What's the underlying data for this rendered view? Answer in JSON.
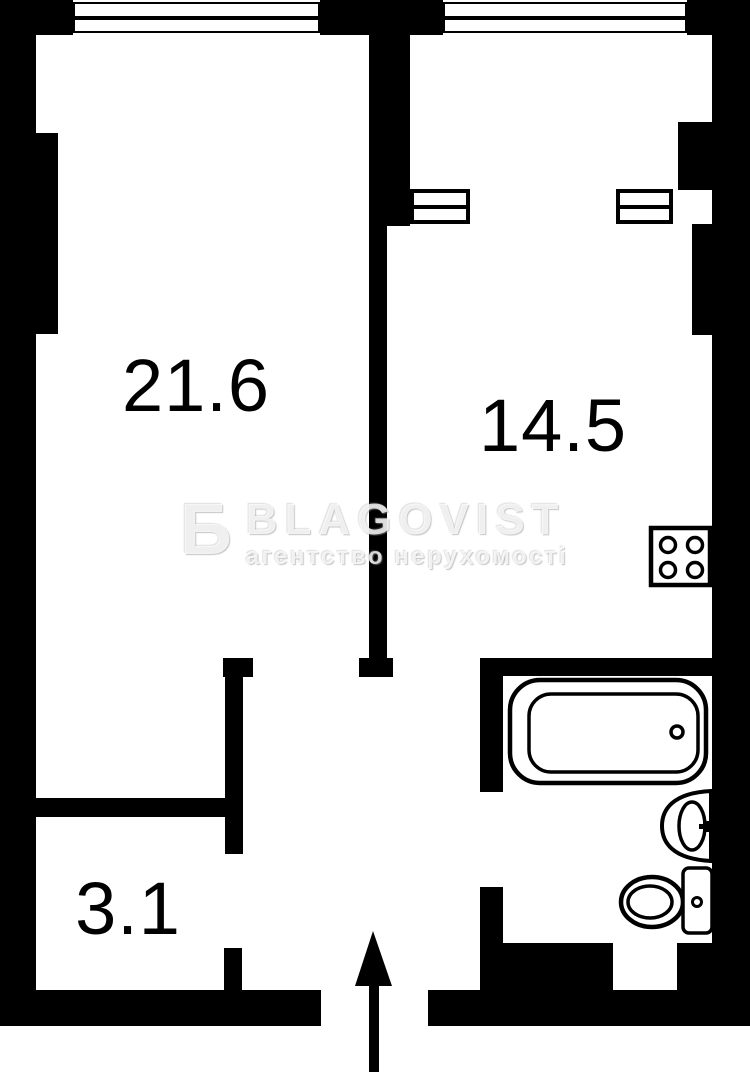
{
  "plan": {
    "type": "apartment-floor-plan",
    "rooms": [
      {
        "id": "living-room",
        "area_label": "21.6"
      },
      {
        "id": "kitchen",
        "area_label": "14.5"
      },
      {
        "id": "hallway",
        "area_label": "3.1"
      }
    ],
    "fixtures": [
      "stove-icon",
      "bathtub-icon",
      "sink-icon",
      "toilet-icon"
    ],
    "windows": 2,
    "entrance": {
      "symbol": "arrow-up"
    },
    "colors": {
      "wall": "#000000",
      "background": "#ffffff",
      "label": "#000000",
      "watermark": "rgba(255,255,255,0.78)"
    }
  },
  "watermark": {
    "logo": "Б",
    "brand": "BLAGOVIST",
    "tagline": "агентство нерухомості"
  }
}
